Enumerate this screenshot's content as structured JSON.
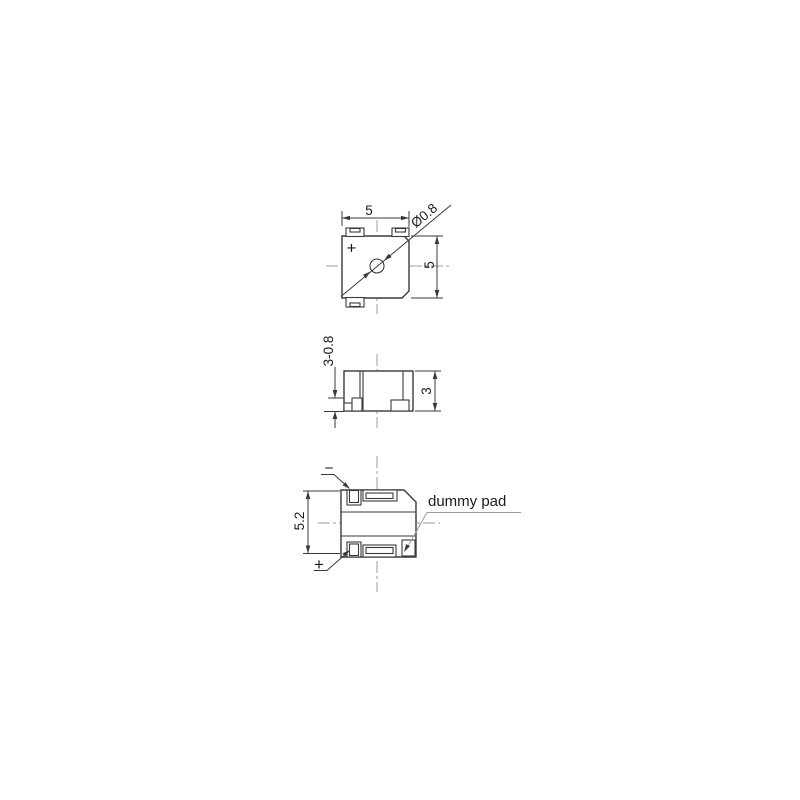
{
  "drawing": {
    "type": "technical-drawing-3-views",
    "labels": {
      "top_view": {
        "width": "5",
        "height": "5",
        "hole_diameter": "Ø0.8",
        "plus_mark": "+"
      },
      "side_view": {
        "height": "3",
        "pad_height": "3-0.8"
      },
      "bottom_view": {
        "overall_height": "5.2",
        "minus_mark": "−",
        "plus_mark": "+",
        "dummy_pad": "dummy pad"
      }
    },
    "colors": {
      "line": "#3a3a3a",
      "centerline": "#9b9b9b",
      "leader": "#9b9b9b",
      "text": "#1a1a1a",
      "background": "#ffffff"
    }
  }
}
